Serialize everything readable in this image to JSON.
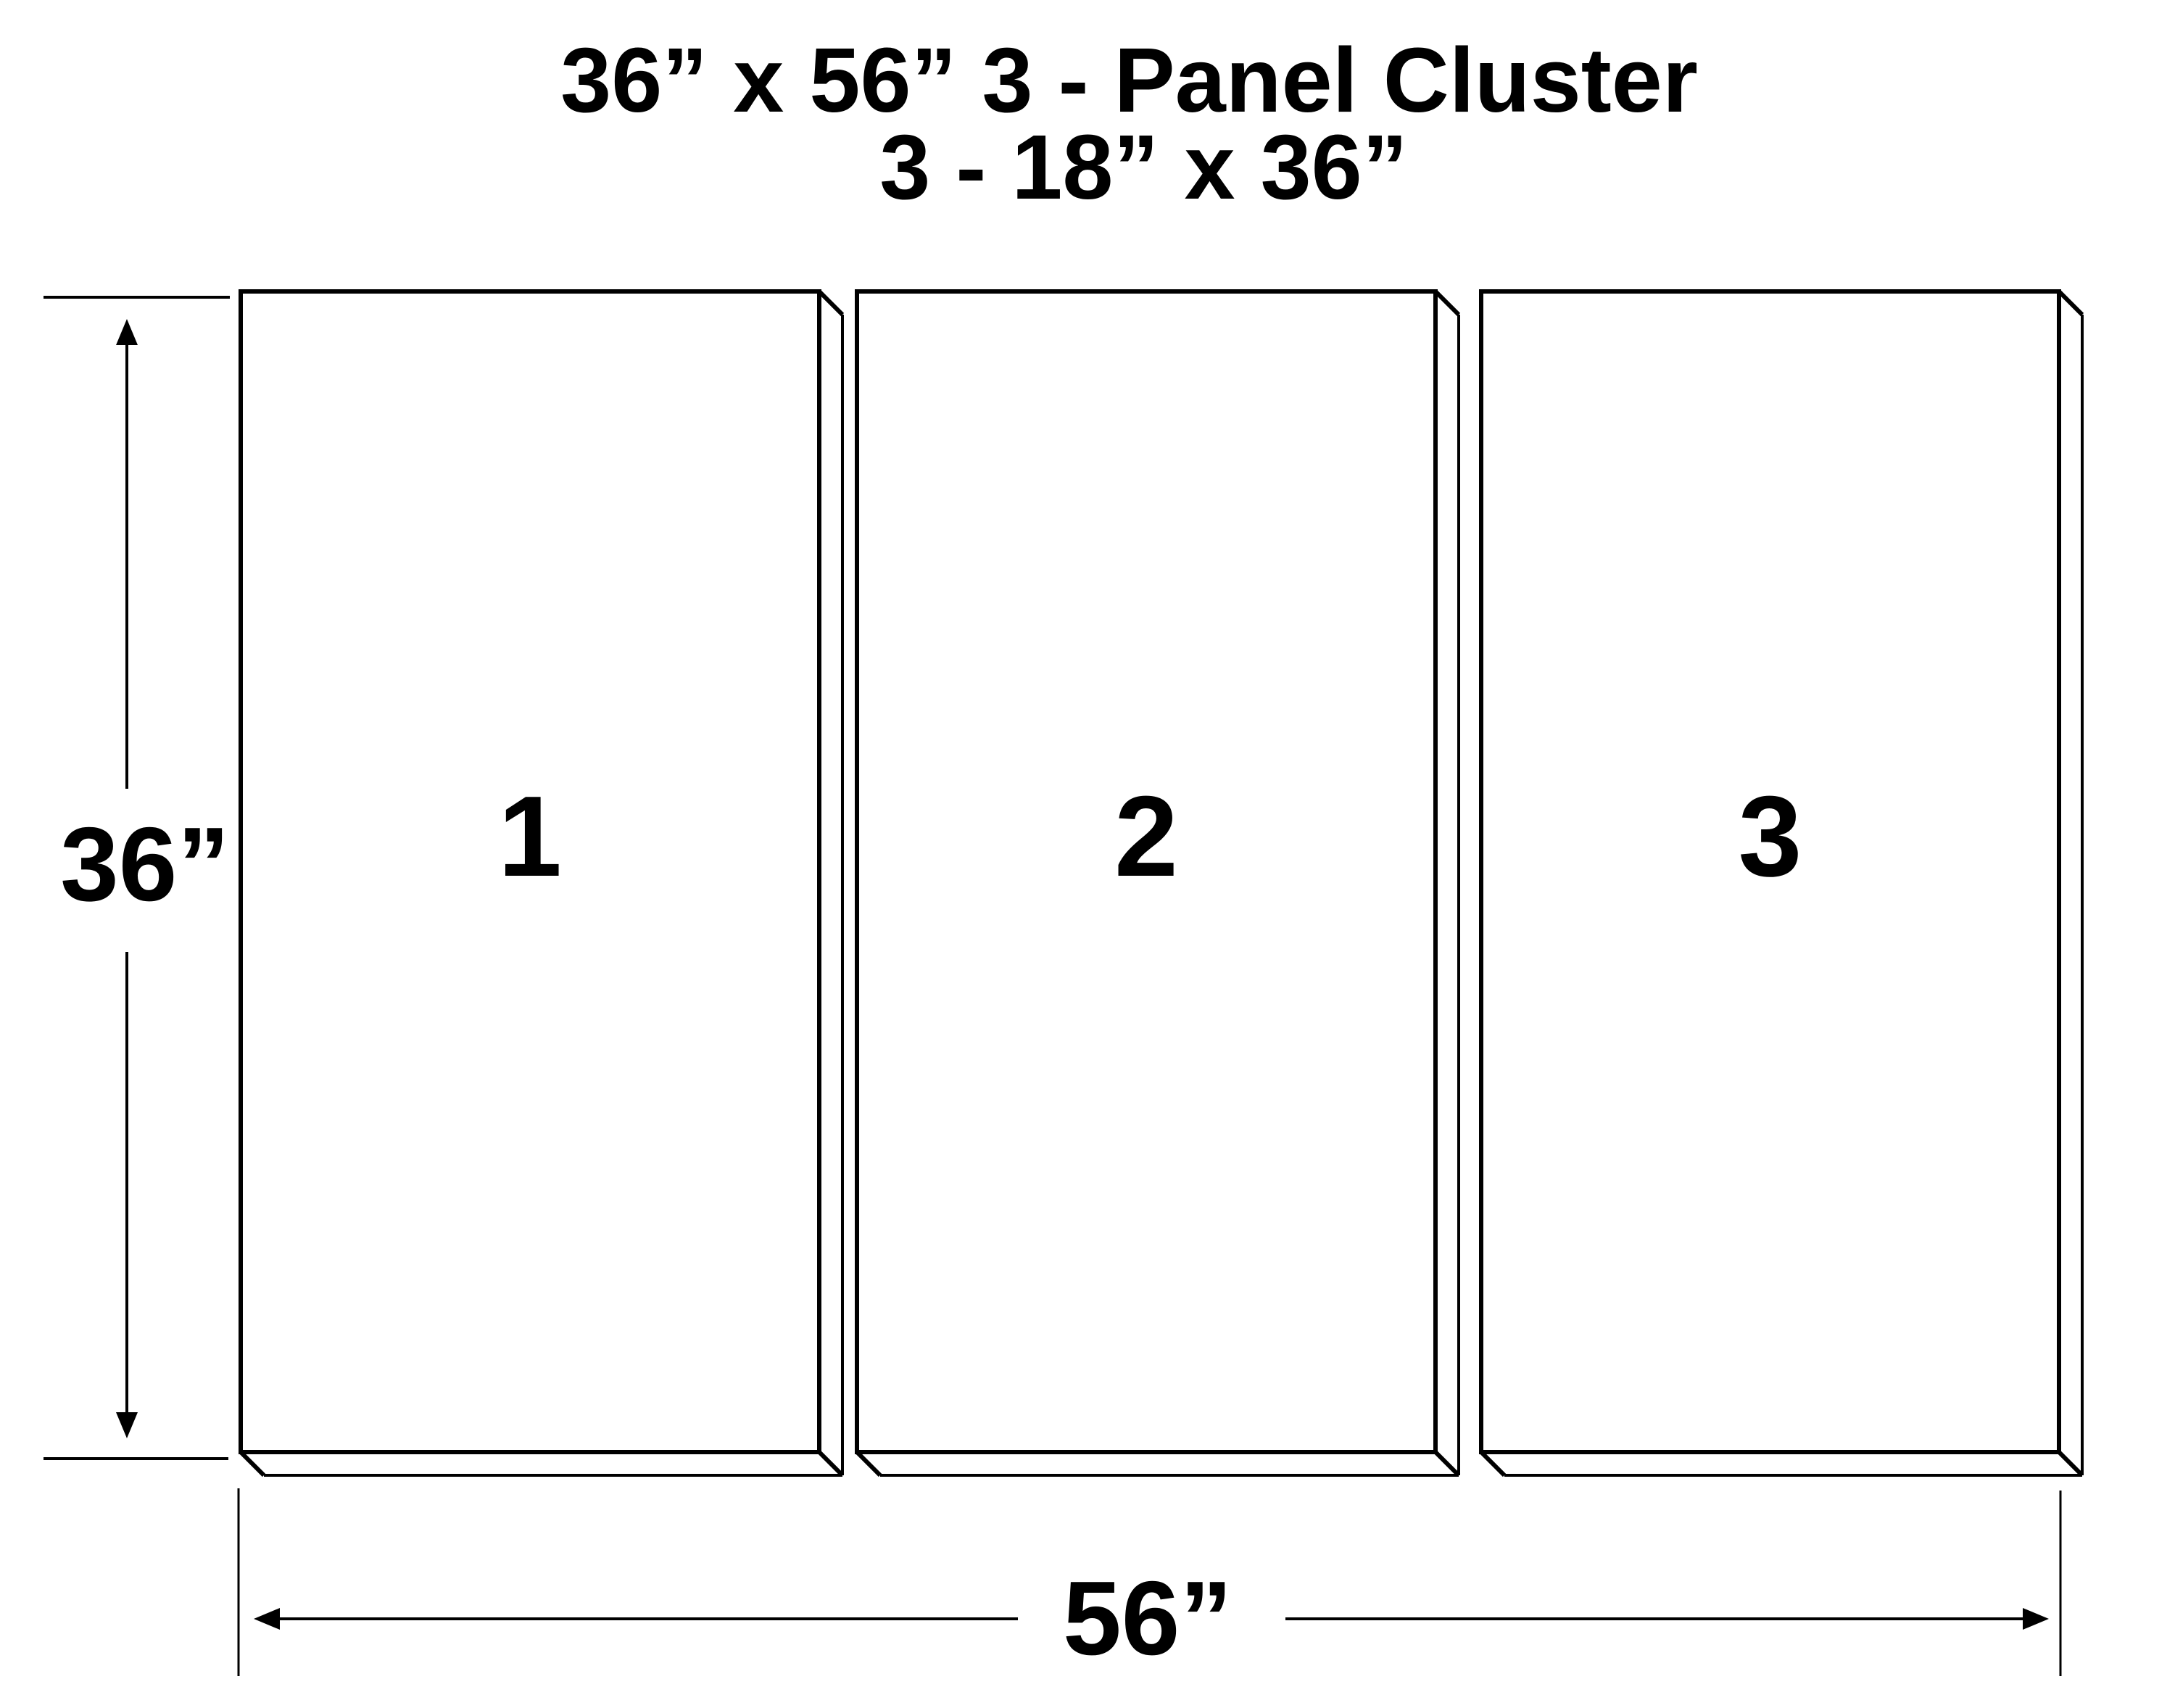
{
  "title": {
    "line1": "36” x 56” 3 - Panel Cluster",
    "line2": "3 - 18” x 36”"
  },
  "panels": [
    {
      "label": "1"
    },
    {
      "label": "2"
    },
    {
      "label": "3"
    }
  ],
  "dimensions": {
    "height_label": "36”",
    "width_label": "56”"
  },
  "colors": {
    "ink": "#000000",
    "background": "#ffffff"
  }
}
